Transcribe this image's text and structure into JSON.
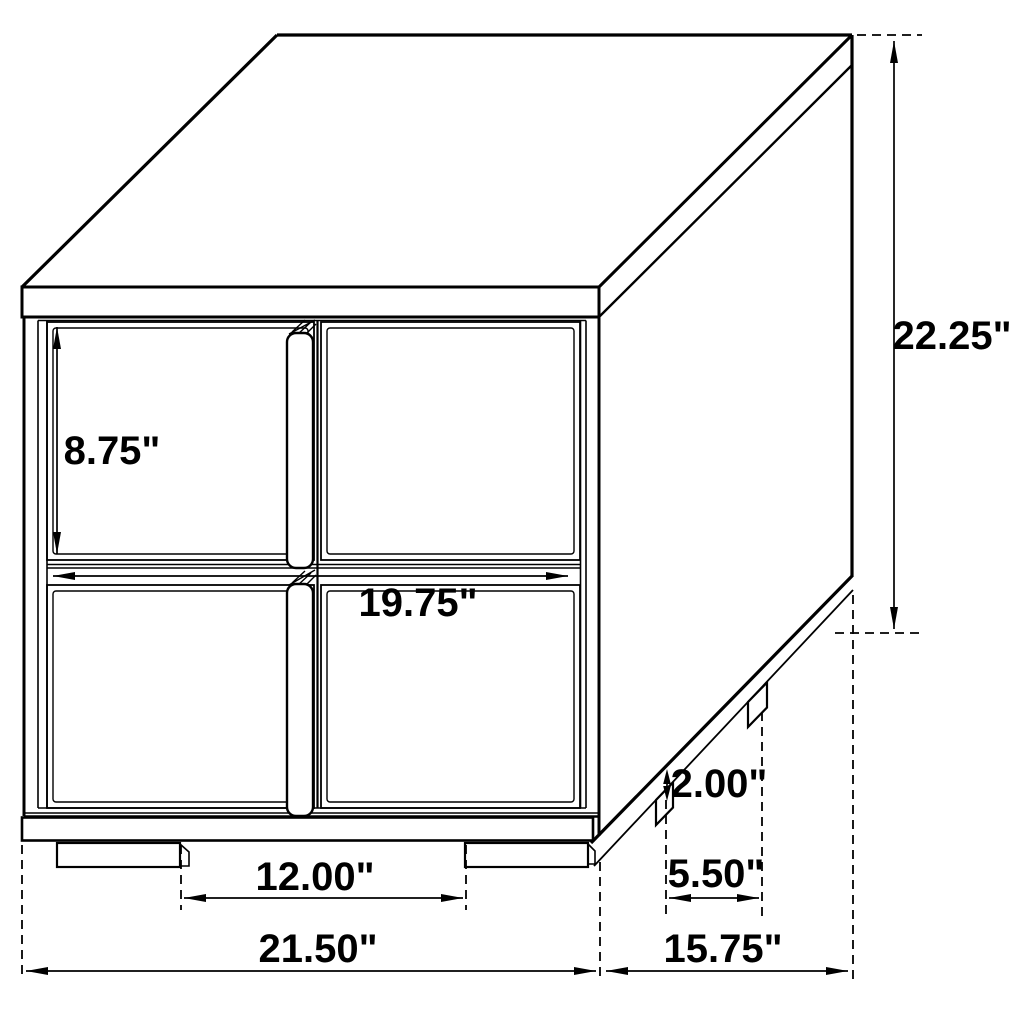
{
  "diagram": {
    "unit": "inches",
    "colors": {
      "line": "#000000",
      "background": "#ffffff",
      "text": "#000000"
    },
    "dimensions": {
      "overall_height": {
        "label": "22.25\""
      },
      "overall_width": {
        "label": "21.50\""
      },
      "overall_depth": {
        "label": "15.75\""
      },
      "drawer_height": {
        "label": "8.75\""
      },
      "drawer_width": {
        "label": "19.75\""
      },
      "front_leg_clearance": {
        "label": "12.00\""
      },
      "side_leg_spacing": {
        "label": "5.50\""
      },
      "leg_height": {
        "label": "2.00\""
      }
    }
  }
}
